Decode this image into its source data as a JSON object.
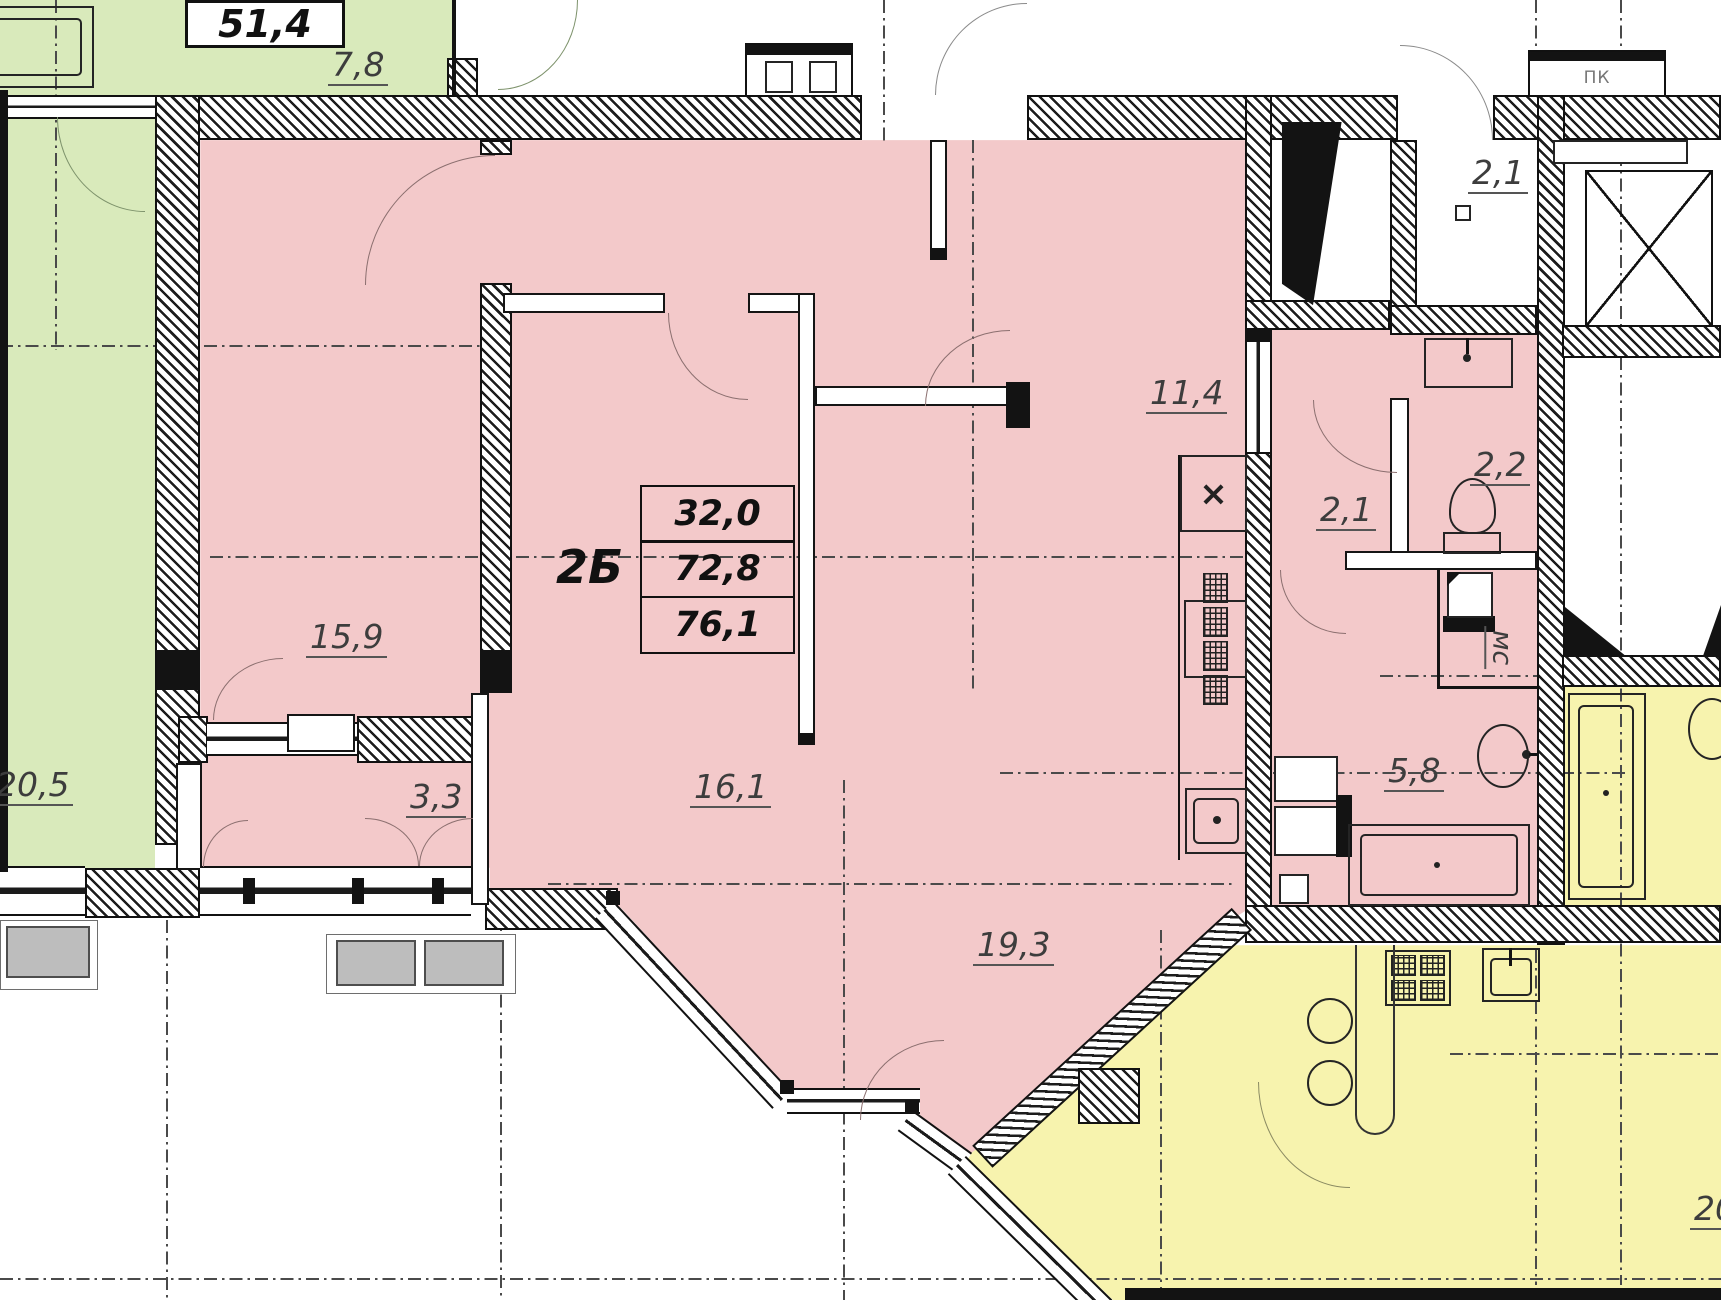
{
  "apartment": {
    "label": "2Б",
    "area_living": "32,0",
    "area_main": "72,8",
    "area_total": "76,1"
  },
  "rooms": {
    "bedroom": "15,9",
    "loggia": "3,3",
    "room": "16,1",
    "hall": "11,4",
    "kitchen_living": "19,3",
    "corridor": "2,1",
    "wc": "2,2",
    "bathroom": "5,8",
    "storage": "мс"
  },
  "left_apartment": {
    "area_total": "51,4",
    "loggia": "7,8",
    "room": "20,5"
  },
  "right_apartment": {
    "room": "20"
  },
  "common": {
    "lobby": "2,1",
    "fire_cabinet": "ПК",
    "vent_mark": "×"
  },
  "colors": {
    "pink": "#f3c9ca",
    "green": "#d9eabb",
    "yellow": "#f7f3ae",
    "wall": "#141414"
  }
}
